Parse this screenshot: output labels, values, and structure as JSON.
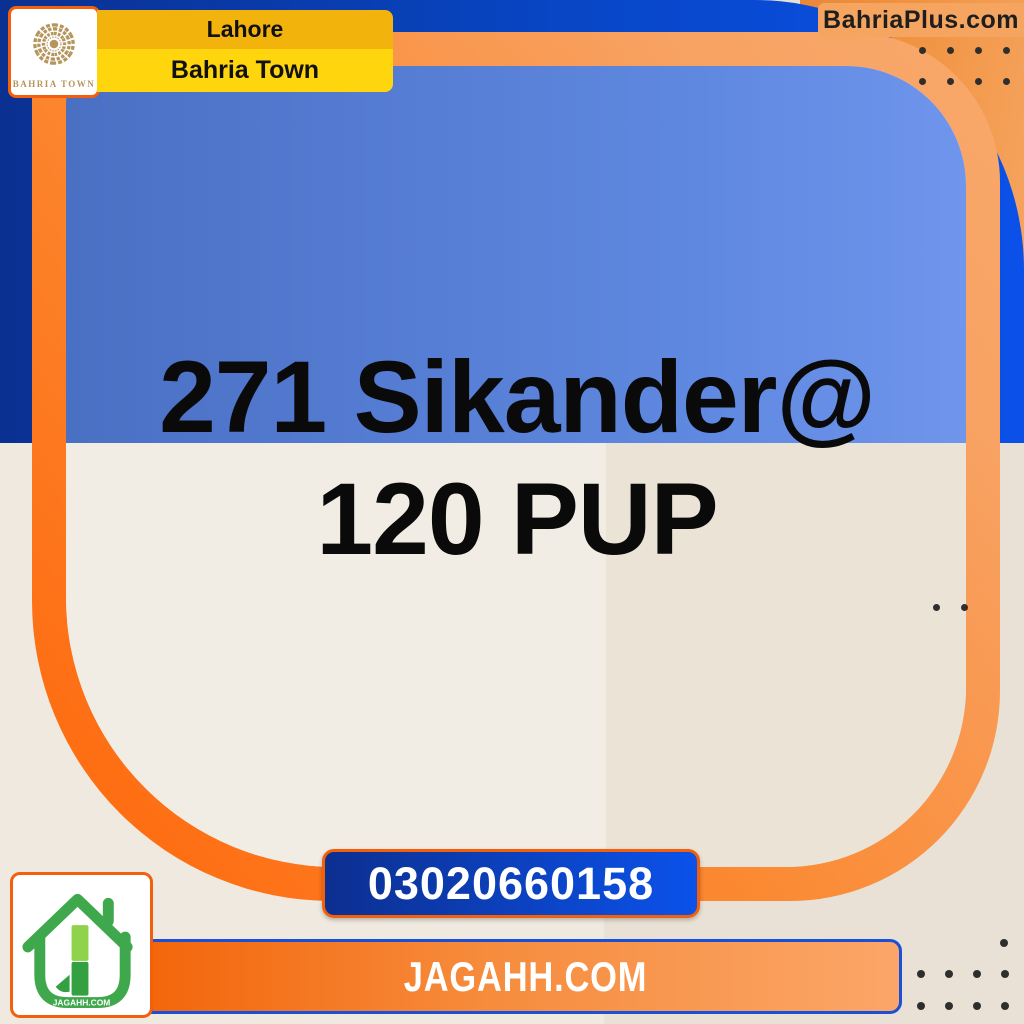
{
  "header": {
    "logo": {
      "label": "BAHRIA TOWN"
    },
    "location_banner": {
      "city": "Lahore",
      "community": "Bahria Town"
    },
    "site_badge": {
      "label": "BahriaPlus.com"
    }
  },
  "listing": {
    "title_line1": "271 Sikander@",
    "title_line2": "120 PUP"
  },
  "footer": {
    "phone": "03020660158",
    "website": "JAGAHH.COM",
    "logo_label": "JAGAHH.COM"
  },
  "colors": {
    "navy": "#0A3091",
    "royal_blue": "#0B50E8",
    "card_border_orange": "#FF660A",
    "peach_orange": "#F8A263",
    "inner_blue": "#4A70C4",
    "beige": "#EDE7DC",
    "amber_band": "#F2B30C",
    "yellow_band": "#FFD60D",
    "phone_badge_blue": "#0C2F90",
    "banner_orange": "#F4660B",
    "banner_border_blue": "#1A4FD8",
    "jagahh_green": "#3FA84C",
    "jagahh_light_green": "#8FD24B",
    "logo_gold": "#B6955C"
  }
}
